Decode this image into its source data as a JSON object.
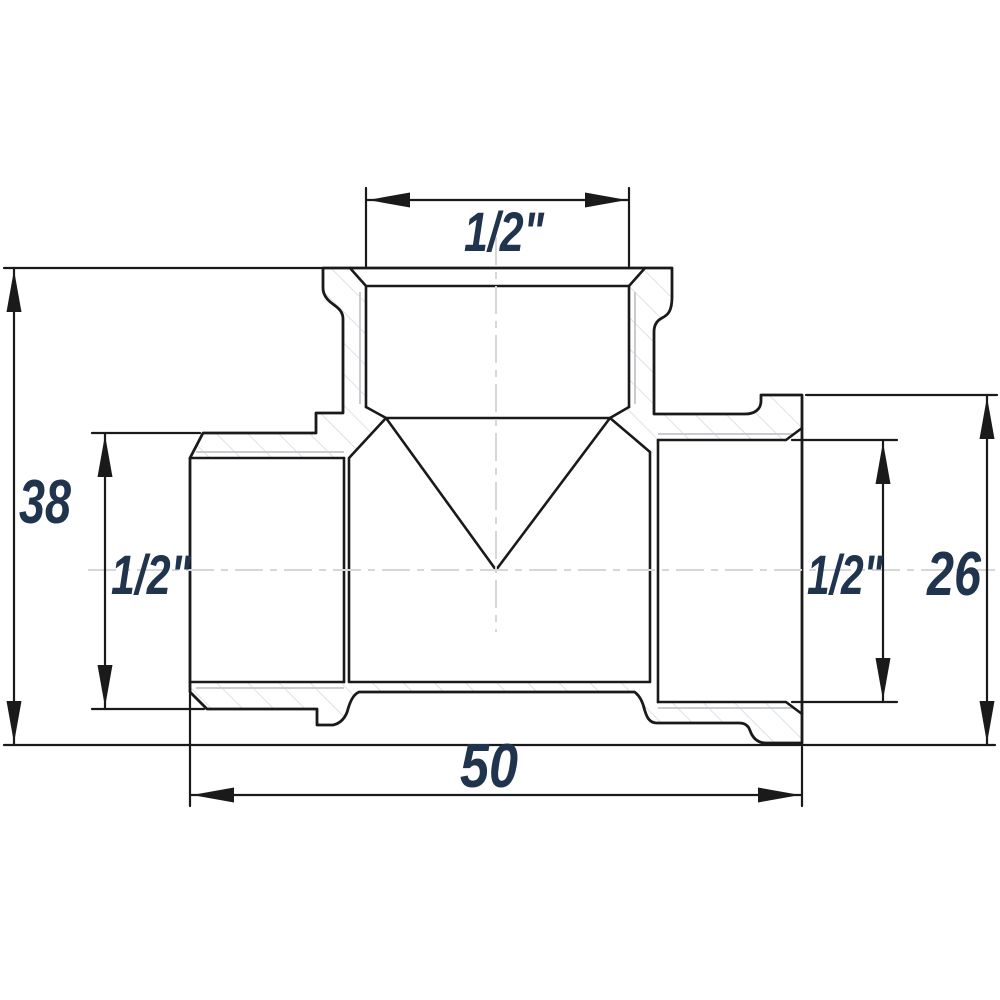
{
  "drawing": {
    "view": "threaded tee pipe fitting, sectional dimension drawing",
    "labels": {
      "top_thread": "1/2\"",
      "left_thread": "1/2\"",
      "right_thread": "1/2\"",
      "overall_height": "38",
      "right_outer_diameter": "26",
      "overall_width": "50"
    },
    "colors": {
      "line": "#1a1a1a",
      "label": "#20344d",
      "hatch": "#d9dcdf",
      "thread": "#c8ccd1",
      "centerline": "#d5d8db",
      "background": "#ffffff"
    }
  }
}
